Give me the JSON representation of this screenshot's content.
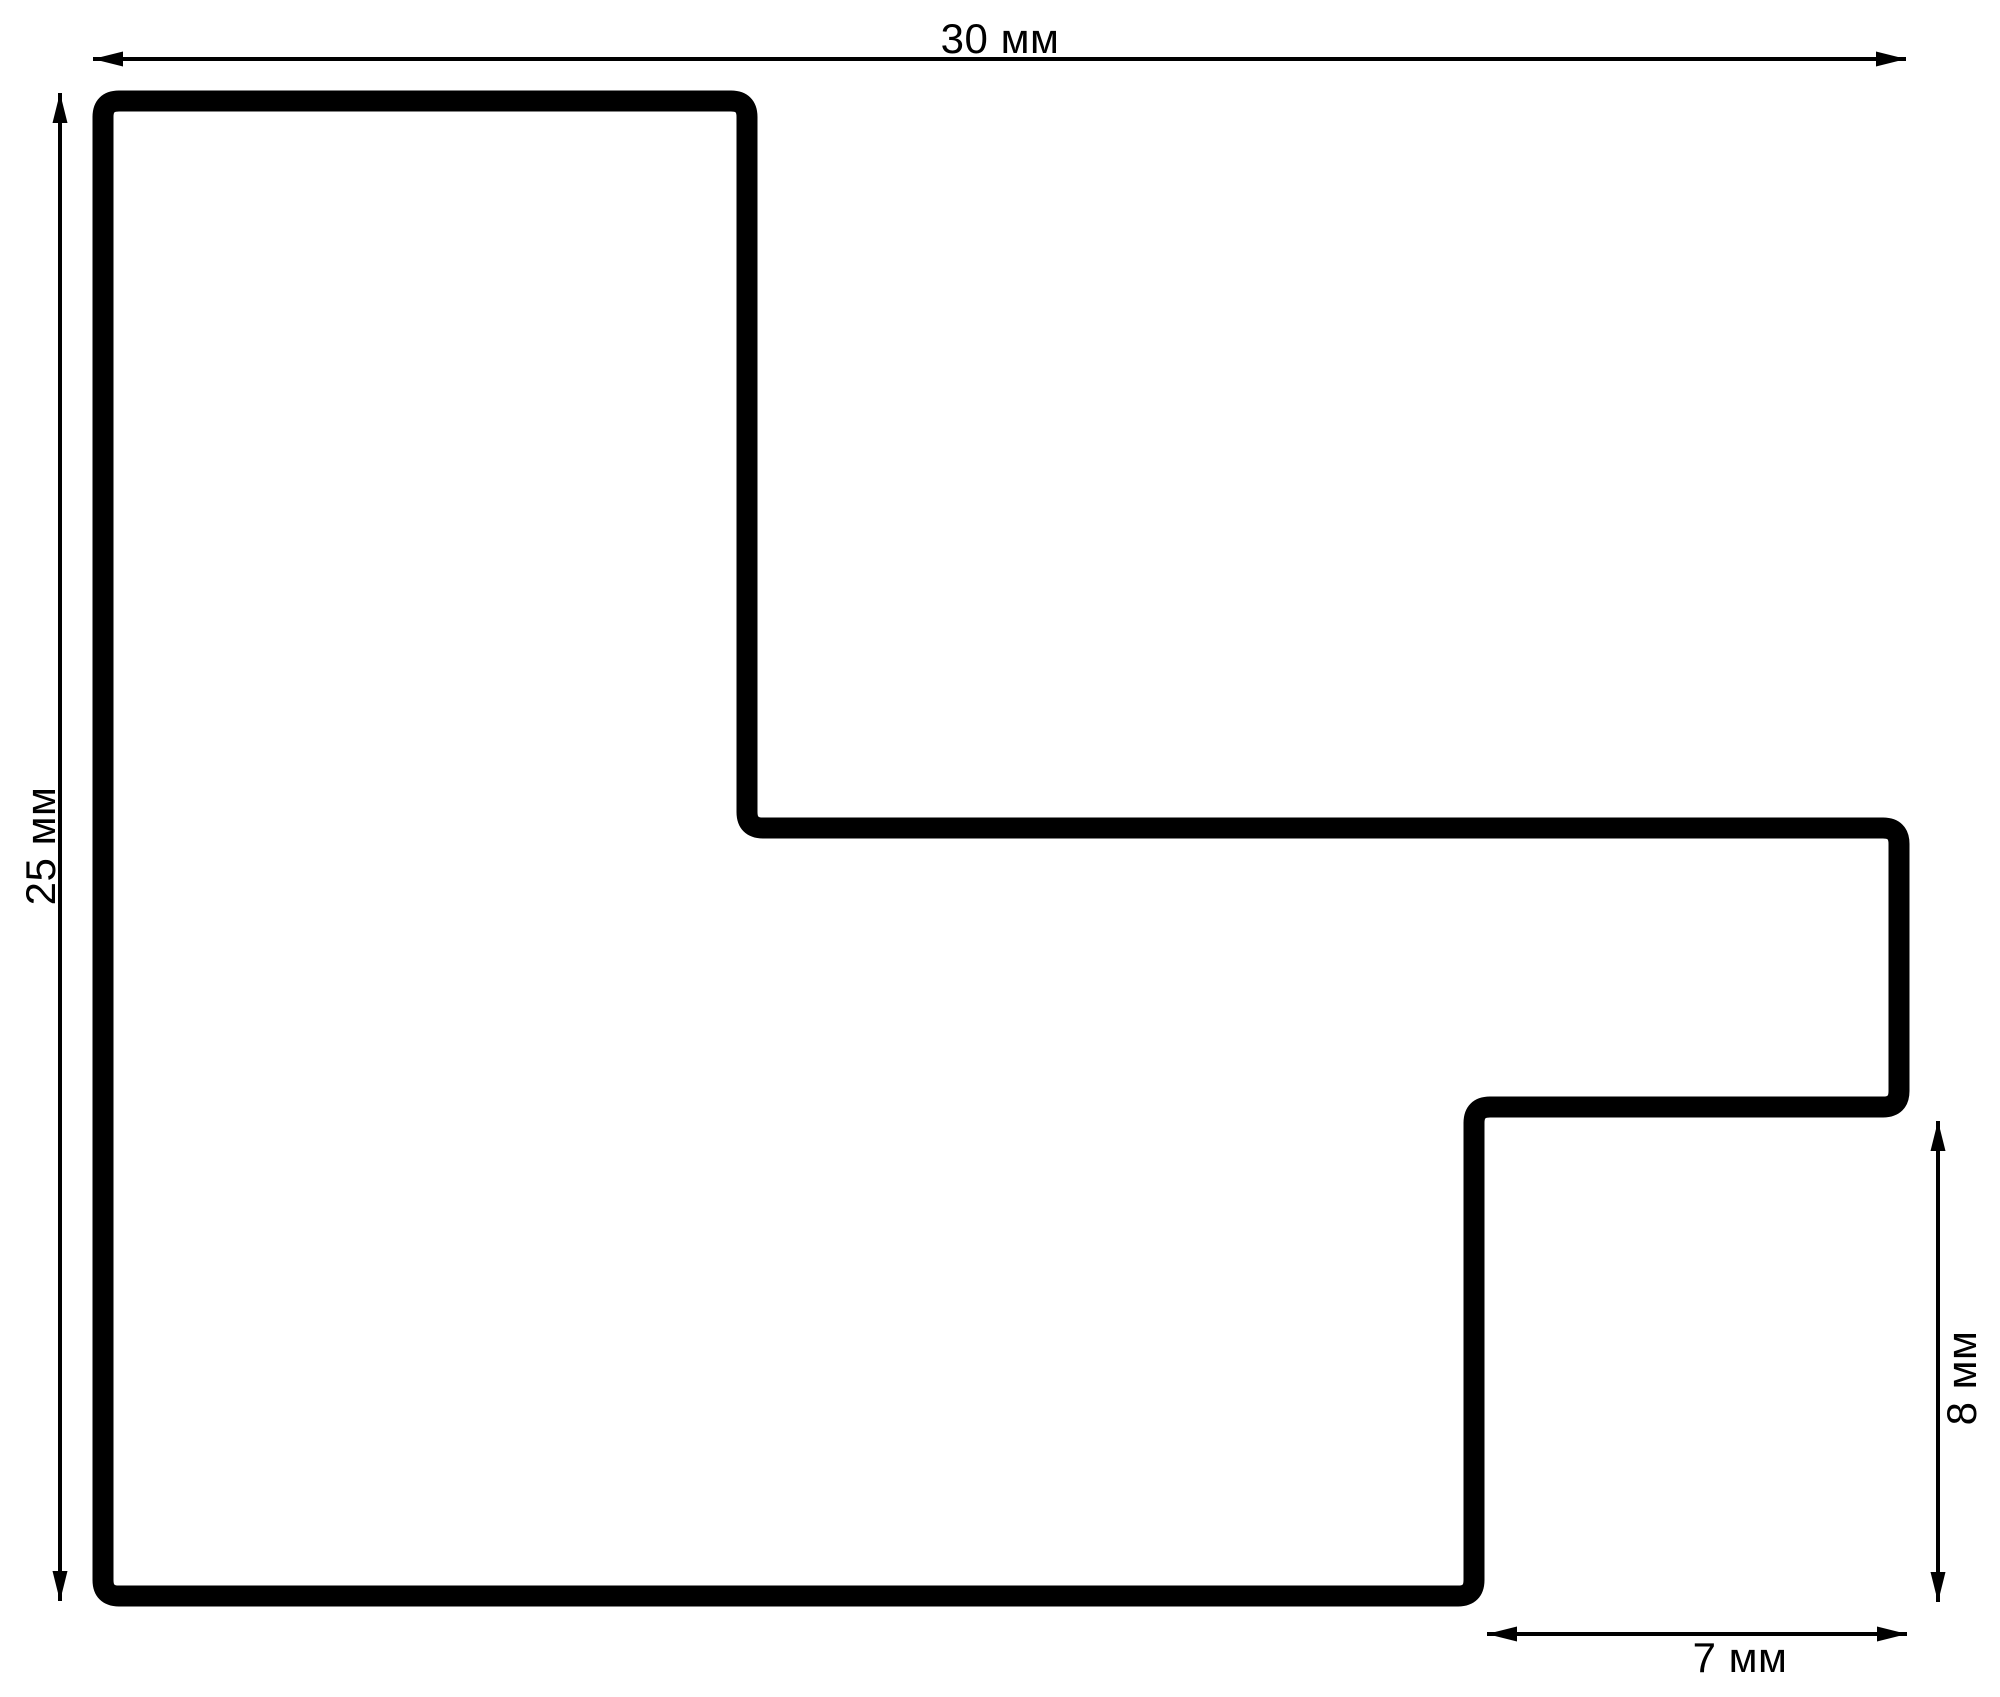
{
  "drawing": {
    "type": "dimensioned profile outline",
    "dimension_labels": {
      "top_width": "30 мм",
      "left_height": "25 мм",
      "right_step_height": "8 мм",
      "bottom_step_width": "7 мм"
    },
    "colors": {
      "ink": "#000000",
      "background": "#ffffff"
    }
  }
}
